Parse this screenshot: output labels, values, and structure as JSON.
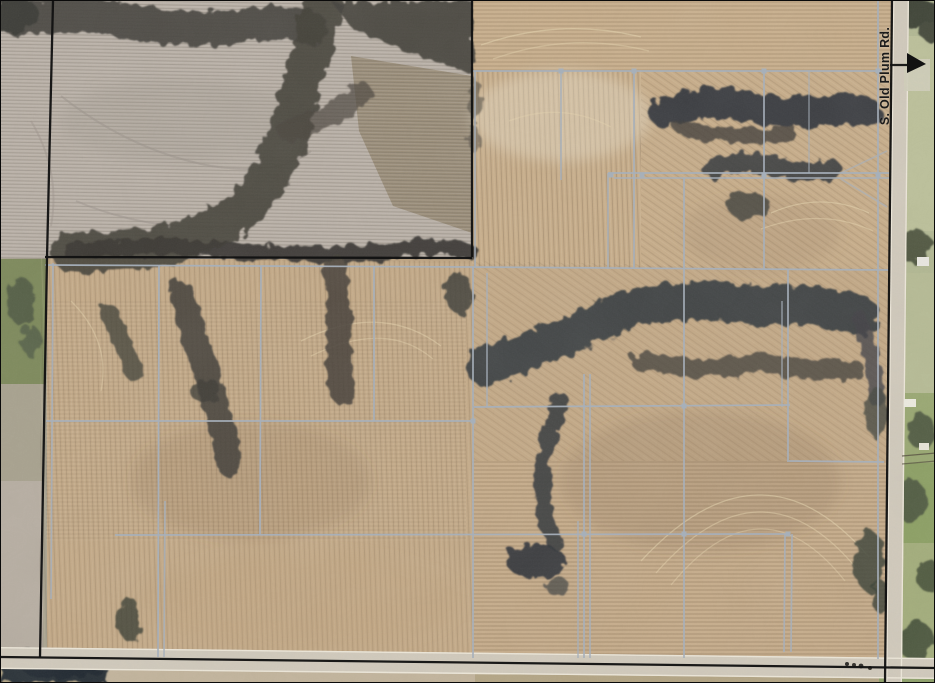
{
  "road_label": {
    "text": "S. Old Plum Rd."
  },
  "colors": {
    "tile_line": "#a7b0bb",
    "boundary_line": "#121212",
    "road_surface": "#d0c9bb",
    "road_edge": "#ece6d8",
    "field_tan": "#c4aa88",
    "field_pale": "#b8afa7",
    "trees_dark": "#3c3e40",
    "grass_green": "#7f8c58"
  },
  "overlay": {
    "tile_lines": [
      [
        471,
        70,
        881,
        70,
        1
      ],
      [
        607,
        172,
        889,
        172,
        1
      ],
      [
        613,
        177,
        889,
        177,
        0.85
      ],
      [
        44,
        264,
        471,
        266,
        1
      ],
      [
        471,
        266,
        889,
        269,
        1
      ],
      [
        45,
        420,
        471,
        420,
        1
      ],
      [
        473,
        406,
        789,
        404,
        1
      ],
      [
        788,
        460,
        883,
        461,
        1
      ],
      [
        114,
        534,
        788,
        533,
        1
      ],
      [
        52,
        262,
        50,
        598,
        0.9
      ],
      [
        158,
        265,
        157,
        656,
        1
      ],
      [
        164,
        500,
        163,
        656,
        0.85
      ],
      [
        260,
        265,
        259,
        534,
        1
      ],
      [
        373,
        265,
        373,
        420,
        1
      ],
      [
        474,
        70,
        474,
        266,
        0.9
      ],
      [
        472,
        266,
        472,
        657,
        1
      ],
      [
        486,
        272,
        486,
        406,
        0.8
      ],
      [
        560,
        70,
        560,
        179,
        0.9
      ],
      [
        633,
        70,
        633,
        268,
        1
      ],
      [
        607,
        172,
        607,
        268,
        0.85
      ],
      [
        683,
        177,
        683,
        657,
        1
      ],
      [
        763,
        70,
        763,
        268,
        1
      ],
      [
        808,
        70,
        808,
        172,
        0.6
      ],
      [
        877,
        0,
        877,
        658,
        1
      ],
      [
        787,
        269,
        787,
        461,
        1
      ],
      [
        781,
        300,
        781,
        406,
        0.7
      ],
      [
        583,
        373,
        583,
        657,
        1
      ],
      [
        589,
        373,
        589,
        657,
        0.9
      ],
      [
        577,
        520,
        577,
        657,
        0.8
      ],
      [
        784,
        533,
        783,
        651,
        0.9
      ],
      [
        791,
        533,
        790,
        651,
        0.9
      ],
      [
        840,
        172,
        886,
        150,
        0.65
      ],
      [
        840,
        178,
        886,
        206,
        0.65
      ]
    ],
    "junctions": [
      [
        560,
        70
      ],
      [
        633,
        70
      ],
      [
        763,
        70
      ],
      [
        877,
        70
      ],
      [
        610,
        174
      ],
      [
        641,
        174
      ],
      [
        763,
        174
      ],
      [
        877,
        174
      ],
      [
        683,
        405
      ],
      [
        472,
        420
      ],
      [
        583,
        533
      ],
      [
        683,
        533
      ],
      [
        787,
        533
      ]
    ],
    "boundary_lines": [
      [
        52,
        0,
        46,
        257
      ],
      [
        46,
        257,
        39,
        656
      ],
      [
        44,
        256,
        471,
        257
      ],
      [
        471,
        0,
        471,
        256
      ],
      [
        891,
        0,
        884,
        683
      ],
      [
        0,
        656,
        935,
        667
      ]
    ],
    "arrow": {
      "line": [
        889,
        64,
        908,
        64
      ],
      "head": [
        [
          906,
          52
        ],
        [
          925,
          63
        ],
        [
          906,
          72
        ]
      ]
    }
  }
}
